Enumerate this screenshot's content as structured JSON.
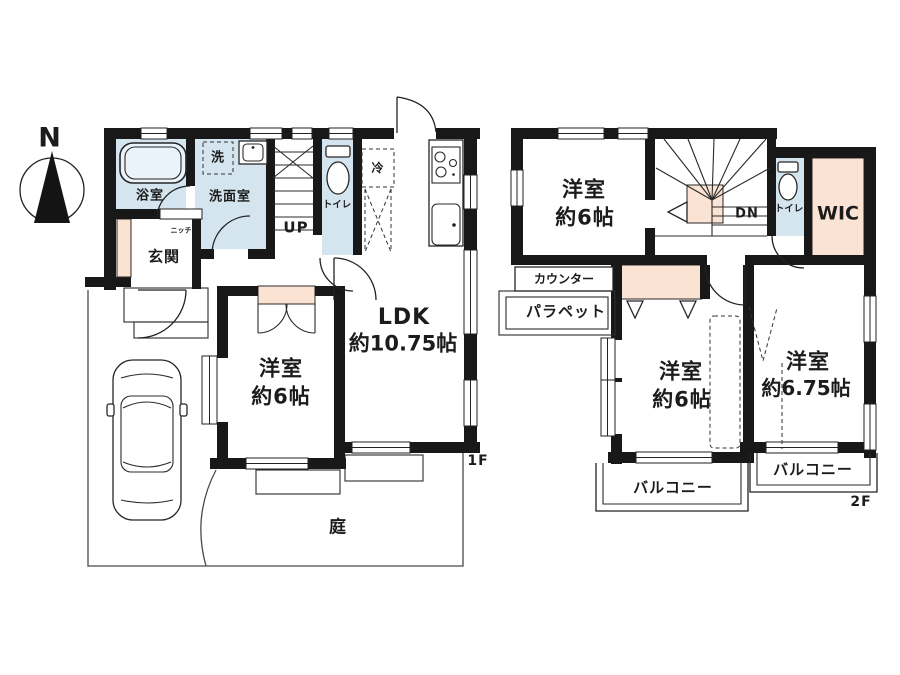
{
  "compass": {
    "north_label": "N"
  },
  "floor1": {
    "floor_label": "1F",
    "rooms": {
      "bathroom": "浴室",
      "washing_machine": "洗",
      "washroom": "洗面室",
      "stairs_up": "UP",
      "toilet": "トイレ",
      "niche": "ニッチ",
      "entrance": "玄関",
      "refrigerator": "冷",
      "bedroom_name": "洋室",
      "bedroom_size": "約6帖",
      "ldk_name": "LDK",
      "ldk_size": "約10.75帖",
      "garden": "庭"
    }
  },
  "floor2": {
    "floor_label": "2F",
    "rooms": {
      "bedroom1_name": "洋室",
      "bedroom1_size": "約6帖",
      "stairs_down": "DN",
      "toilet": "トイレ",
      "walk_in_closet": "WIC",
      "counter": "カウンター",
      "parapet": "パラペット",
      "bedroom2_name": "洋室",
      "bedroom2_size": "約6帖",
      "bedroom3_name": "洋室",
      "bedroom3_size": "約6.75帖",
      "balcony_left": "バルコニー",
      "balcony_right": "バルコニー"
    }
  },
  "colors": {
    "wall": "#181818",
    "wet_area": "#d5e5ef",
    "closet": "#fae3d3",
    "background": "#ffffff"
  }
}
